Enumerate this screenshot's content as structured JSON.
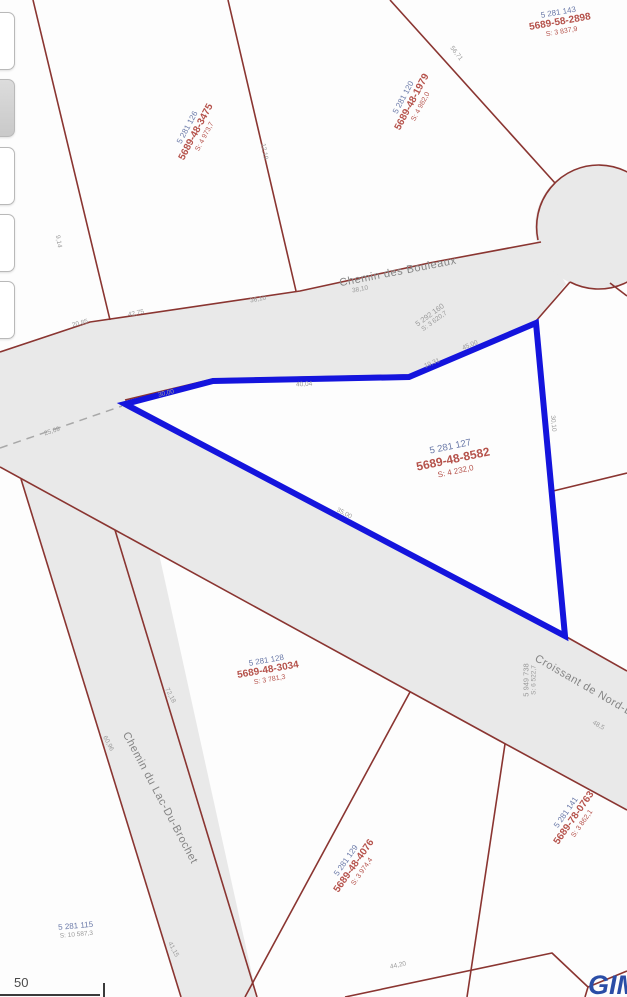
{
  "colors": {
    "parcel_line": "#8a3531",
    "highlight_outline": "#1414dd",
    "road_fill": "#e9e9e9",
    "lot_number_blue": "#6a79a8",
    "matricule_red": "#b5524b",
    "road_text_gray": "#858585",
    "logo_blue": "#2a4da6"
  },
  "roads": [
    {
      "name": "Chemin des Bouleaux"
    },
    {
      "name": "Chemin du Lac-Du-Brochet"
    },
    {
      "name": "Croissant de Nord-Est"
    }
  ],
  "parcels": [
    {
      "lot": "5 281 143",
      "mat": "5689-58-2898",
      "area": "S: 3 837,9"
    },
    {
      "lot": "5 281 120",
      "mat": "5689-48-1979",
      "area": "S: 4 982,0"
    },
    {
      "lot": "5 281 126",
      "mat": "5689-48-3475",
      "area": "S: 4 973,7"
    },
    {
      "lot": "5 281 127",
      "mat": "5689-48-8582",
      "area": "S: 4 232,0"
    },
    {
      "lot": "5 281 128",
      "mat": "5689-48-3034",
      "area": "S: 3 781,3"
    },
    {
      "lot": "5 281 129",
      "mat": "5689-48-4076",
      "area": "S: 3 974,4"
    },
    {
      "lot": "5 281 141",
      "mat": "5689-78-0763",
      "area": "S: 3 862,1"
    },
    {
      "lot": "5 281 115",
      "area": "S: 10 587,3"
    }
  ],
  "road_lots": [
    {
      "lot": "5 292 160",
      "area": "S: 3 620,7"
    },
    {
      "lot": "5 949 738",
      "area": "S: 6 522,7"
    }
  ],
  "dims": [
    {
      "t": "9,14"
    },
    {
      "t": "12,19"
    },
    {
      "t": "56,71"
    },
    {
      "t": "20,85"
    },
    {
      "t": "42,75"
    },
    {
      "t": "36,10"
    },
    {
      "t": "38,10"
    },
    {
      "t": "30,00"
    },
    {
      "t": "40,04"
    },
    {
      "t": "45,00"
    },
    {
      "t": "19,31"
    },
    {
      "t": "30,10"
    },
    {
      "t": "25,09"
    },
    {
      "t": "35,00"
    },
    {
      "t": "48,5"
    },
    {
      "t": "72,18"
    },
    {
      "t": "60,96"
    },
    {
      "t": "41,15"
    },
    {
      "t": "44,20"
    }
  ],
  "scale": {
    "label": "50"
  },
  "logo": {
    "text": "GIM"
  }
}
